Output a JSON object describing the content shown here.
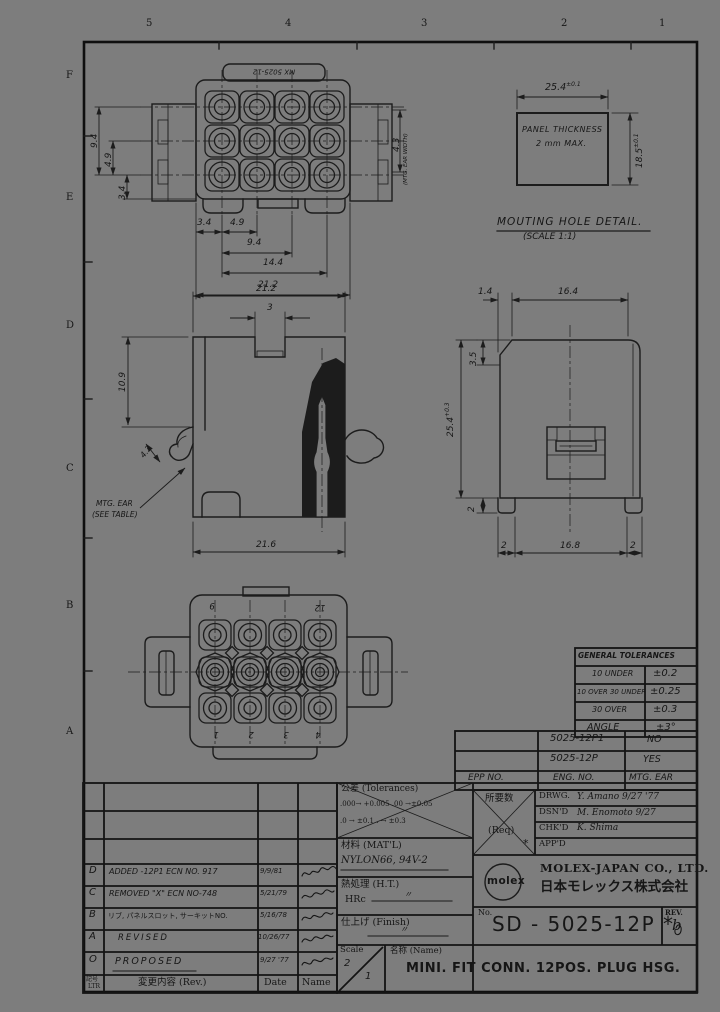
{
  "sheet": {
    "zones_top": [
      "5",
      "4",
      "3",
      "2",
      "1"
    ],
    "zones_left": [
      "F",
      "E",
      "D",
      "C",
      "B",
      "A"
    ]
  },
  "front_view": {
    "marking": "MX 5025-12",
    "dim_left_outer": "9.4",
    "dim_left_mid": "4.9",
    "dim_left_inner": "3.4",
    "dim_right": "4.3",
    "dim_right_note": "(MTG. EAR WIDTH)",
    "dim_bottom_a": "3.4",
    "dim_bottom_b": "4.9",
    "dim_bottom_c": "9.4",
    "dim_bottom_d": "14.4",
    "dim_bottom_e": "21.2"
  },
  "mounting_hole": {
    "dim_width": "25.4",
    "dim_width_tol": "±0.1",
    "dim_height": "18.5",
    "dim_height_tol": "±0.1",
    "panel_note_1": "PANEL THICKNESS",
    "panel_note_2": "2 mm MAX.",
    "caption_1": "MOUTING  HOLE  DETAIL.",
    "caption_2": "(SCALE 1:1)"
  },
  "side_view": {
    "dim_top": "21.2",
    "dim_notch": "3",
    "dim_left": "10.9",
    "dim_ear": "4.3",
    "dim_bottom": "21.6",
    "note_1": "MTG. EAR",
    "note_2": "(SEE TABLE)"
  },
  "end_view": {
    "dim_top_a": "1.4",
    "dim_top_b": "16.4",
    "dim_chamfer": "3.5",
    "dim_height": "25.4",
    "dim_height_tol": "+0.3",
    "dim_foot": "2",
    "dim_bottom_a": "2",
    "dim_bottom_b": "16.8",
    "dim_bottom_c": "2"
  },
  "rear_view": {
    "pin_top_left": "9",
    "pin_top_right": "12",
    "pin_bottom": [
      "1",
      "2",
      "3",
      "4"
    ]
  },
  "tolerance_table": {
    "title": "GENERAL TOLERANCES",
    "rows": [
      {
        "range": "10 UNDER",
        "tol": "±0.2"
      },
      {
        "range": "10 OVER 30 UNDER",
        "tol": "±0.25"
      },
      {
        "range": "30 OVER",
        "tol": "±0.3"
      },
      {
        "range": "ANGLE",
        "tol": "±3°"
      }
    ]
  },
  "part_table": {
    "rows": [
      {
        "eng": "5025-12P1",
        "ear": "NO"
      },
      {
        "eng": "5025-12P",
        "ear": "YES"
      }
    ],
    "header": {
      "epp": "EPP NO.",
      "eng": "ENG. NO.",
      "ear": "MTG. EAR"
    }
  },
  "spec_block": {
    "tol_label": "公差 (Tolerances)",
    "tol_line1": ".000→ +0.005   .00 →±0.05",
    "tol_line2": ".0 → ±0.1        . → ±0.3",
    "matl_label": "材料 (MAT'L)",
    "matl_value": "NYLON66, 94V-2",
    "ht_label": "熱処理 (H.T.)",
    "ht_hrc": "HRc",
    "ht_value": "〃",
    "finish_label": "仕上げ (Finish)",
    "finish_value": "〃",
    "scale_label": "Scale",
    "scale_top": "2",
    "scale_bottom": "1",
    "name_label": "名称 (Name)",
    "name_value": "MINI. FIT  CONN. 12POS.  PLUG  HSG."
  },
  "title_block": {
    "req_label": "所要数",
    "req_sub": "(Req)",
    "req_mark": "*",
    "sig_rows": [
      {
        "label": "DRWG.",
        "value": "Y. Amano  9/27 '77"
      },
      {
        "label": "DSN'D",
        "value": "M. Enomoto  9/27"
      },
      {
        "label": "CHK'D",
        "value": "K. Shima"
      },
      {
        "label": "APP'D",
        "value": ""
      }
    ],
    "logo": "molex",
    "company_en": "MOLEX-JAPAN  CO., LTD.",
    "company_jp": "日本モレックス株式会社",
    "no_label": "No.",
    "no_value": "SD - 5025-12P *",
    "rev_label": "REV.",
    "rev_value": "b"
  },
  "revision_table": {
    "rows": [
      {
        "ltr": "D",
        "desc": "ADDED -12P1 ECN NO. 917",
        "date": "9/9/81"
      },
      {
        "ltr": "C",
        "desc": "REMOVED \"X\" ECN NO-748",
        "date": "5/21/79"
      },
      {
        "ltr": "B",
        "desc": "リブ, パネルスロット, サーキットNO.",
        "date": "5/16/78"
      },
      {
        "ltr": "A",
        "desc": "REVISED",
        "date": "10/26/77"
      },
      {
        "ltr": "O",
        "desc": "PROPOSED",
        "date": "9/27 '77"
      }
    ],
    "footer": {
      "ltr_1": "記号",
      "ltr_2": "LTR",
      "desc": "変更内容  (Rev.)",
      "date": "Date",
      "name": "Name"
    }
  }
}
